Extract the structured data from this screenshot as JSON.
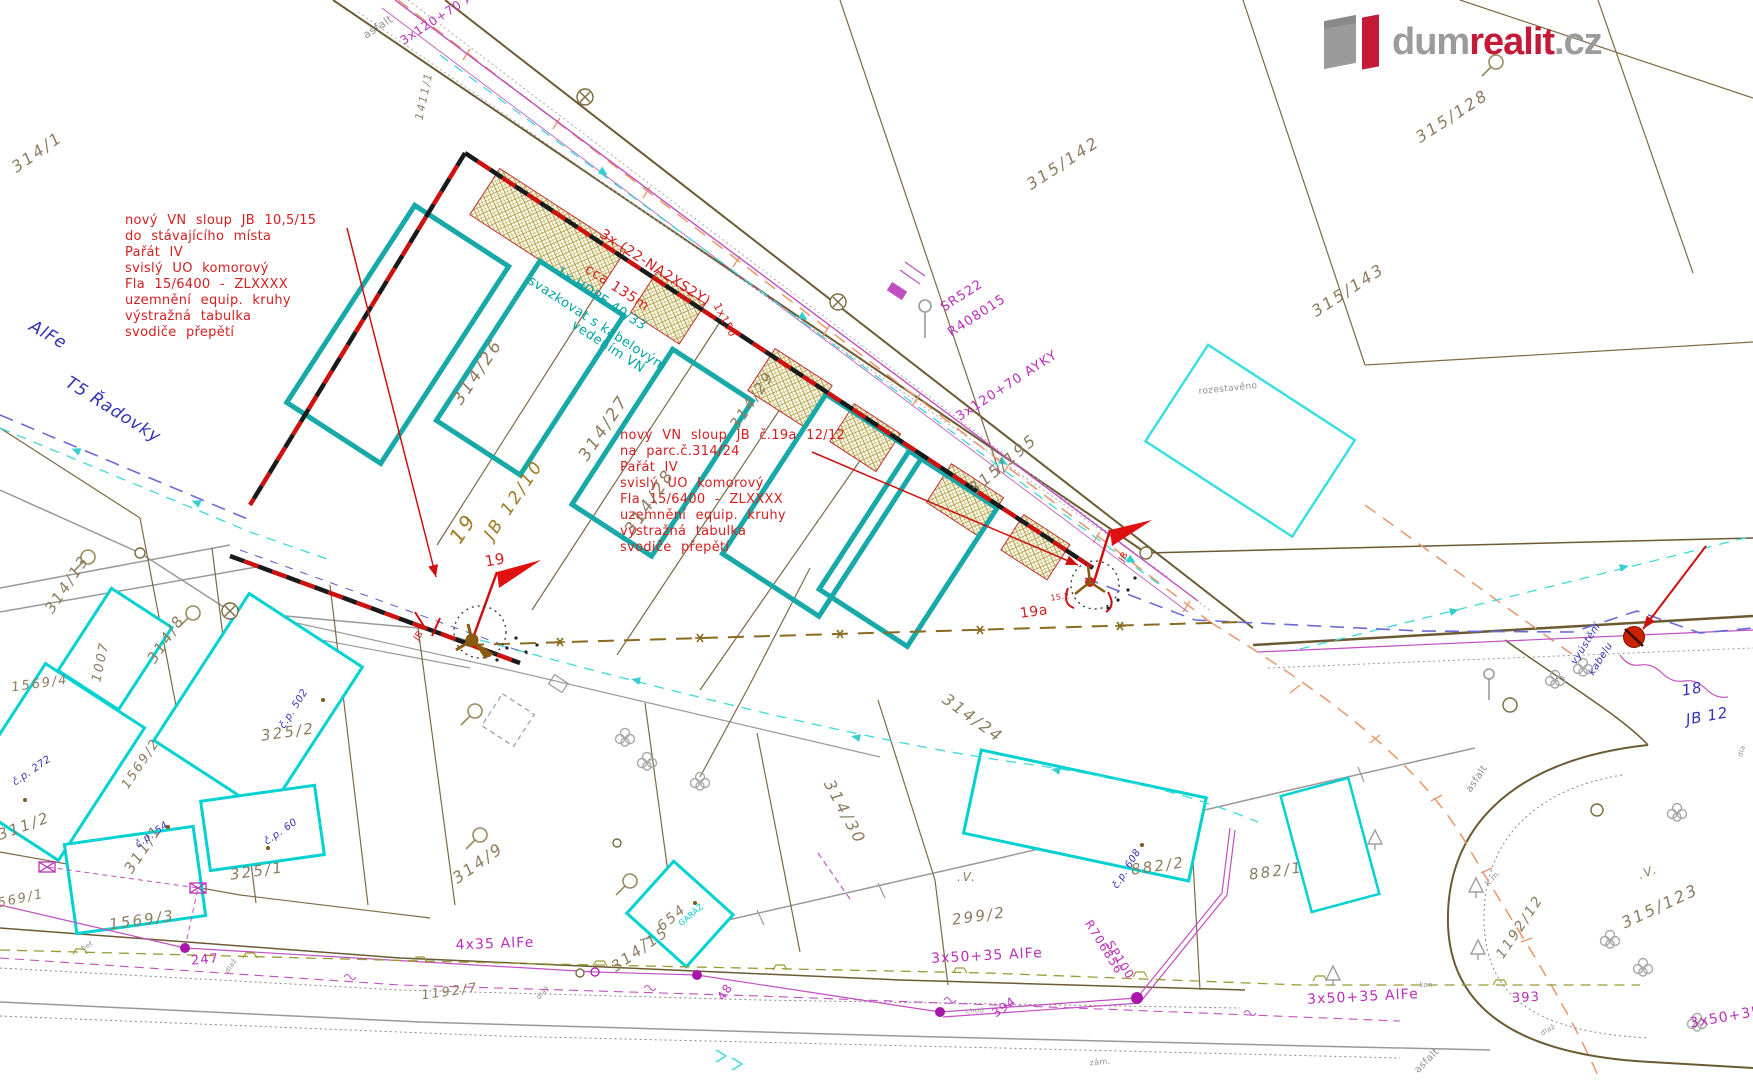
{
  "colors": {
    "brand_red": "#c41937",
    "logo_gray": "#9b9b9b",
    "note_red": "#d21f1f",
    "parcel_brown": "#8d7b5e",
    "utility_magenta": "#bb2fbb",
    "cable_teal": "#00a3a3",
    "house_blue": "#3232b8",
    "map_gray": "#909090",
    "pole_brown": "#a07820"
  },
  "logo": {
    "dum": "dum",
    "realit": "realit",
    "tld": ".cz"
  },
  "blocks": {
    "left": {
      "x": 125,
      "y": 213,
      "lines": [
        "nový VN sloup JB 10,5/15",
        "do stávajícího místa",
        "Pařát IV",
        "svislý UO komorový",
        "Fla 15/6400 - ZLXXXX",
        "uzemnění equip. kruhy",
        "výstražná tabulka",
        "svodiče přepětí"
      ]
    },
    "center": {
      "x": 620,
      "y": 428,
      "lines": [
        "nový VN sloup JB č.19a 12/12",
        "na parc.č.314/24",
        "Pařát IV",
        "svislý UO komorový",
        "Fla 15/6400 - ZLXXXX",
        "uzemnění equip. kruhy",
        "výstražná tabulka",
        "svodiče přepětí"
      ]
    }
  },
  "labels": [
    {
      "t": "314/1",
      "x": 37,
      "y": 152,
      "r": -35,
      "c": "#8d7b5e",
      "s": 16,
      "cls": "parcel"
    },
    {
      "t": "1411/1",
      "x": 424,
      "y": 96,
      "r": -78,
      "c": "#8d7b5e",
      "s": 11,
      "cls": "parcel"
    },
    {
      "t": "asfalt",
      "x": 378,
      "y": 27,
      "r": -33,
      "c": "#909090",
      "s": 11,
      "cls": "note"
    },
    {
      "t": "3x120+70 AYKY",
      "x": 447,
      "y": 12,
      "r": -33,
      "c": "#bb2fbb",
      "s": 12,
      "cls": "util"
    },
    {
      "t": "SR522",
      "x": 962,
      "y": 296,
      "r": -33,
      "c": "#bb2fbb",
      "s": 13,
      "cls": "util"
    },
    {
      "t": "R408015",
      "x": 977,
      "y": 316,
      "r": -33,
      "c": "#bb2fbb",
      "s": 13,
      "cls": "util"
    },
    {
      "t": "3x120+70 AYKY",
      "x": 1007,
      "y": 386,
      "r": -33,
      "c": "#bb2fbb",
      "s": 13,
      "cls": "util"
    },
    {
      "t": "315/128",
      "x": 1452,
      "y": 116,
      "r": -33,
      "c": "#8d7b5e",
      "s": 16,
      "cls": "parcel"
    },
    {
      "t": "315/142",
      "x": 1063,
      "y": 163,
      "r": -33,
      "c": "#8d7b5e",
      "s": 16,
      "cls": "parcel"
    },
    {
      "t": "315/143",
      "x": 1348,
      "y": 290,
      "r": -33,
      "c": "#8d7b5e",
      "s": 16,
      "cls": "parcel"
    },
    {
      "t": "315/195",
      "x": 1003,
      "y": 464,
      "r": -40,
      "c": "#8d7b5e",
      "s": 16,
      "cls": "parcel"
    },
    {
      "t": "rozestavěno",
      "x": 1228,
      "y": 389,
      "r": -6,
      "c": "#909090",
      "s": 9,
      "cls": "note"
    },
    {
      "t": "314/26",
      "x": 478,
      "y": 372,
      "r": -56,
      "c": "#8d7b5e",
      "s": 17,
      "cls": "parcel"
    },
    {
      "t": "314/27",
      "x": 604,
      "y": 428,
      "r": -56,
      "c": "#8d7b5e",
      "s": 17,
      "cls": "parcel"
    },
    {
      "t": "314/28",
      "x": 650,
      "y": 502,
      "r": -56,
      "c": "#8d7b5e",
      "s": 17,
      "cls": "parcel"
    },
    {
      "t": "314/29",
      "x": 752,
      "y": 400,
      "r": -56,
      "c": "#8d7b5e",
      "s": 15,
      "cls": "parcel"
    },
    {
      "t": "19",
      "x": 463,
      "y": 528,
      "r": -56,
      "c": "#a07820",
      "s": 20,
      "cls": "parcel"
    },
    {
      "t": "JB 12/10",
      "x": 514,
      "y": 500,
      "r": -56,
      "c": "#a07820",
      "s": 17,
      "cls": "parcel"
    },
    {
      "t": "3x (22-NA2XS2Y)",
      "x": 655,
      "y": 268,
      "r": 33,
      "c": "#d21f1f",
      "s": 14,
      "cls": "note"
    },
    {
      "t": "cca 135m",
      "x": 617,
      "y": 288,
      "r": 33,
      "c": "#d21f1f",
      "s": 14,
      "cls": "note"
    },
    {
      "t": "1x150",
      "x": 725,
      "y": 320,
      "r": 62,
      "c": "#d21f1f",
      "s": 11,
      "cls": "note"
    },
    {
      "t": "1x HDPE 40/33",
      "x": 601,
      "y": 299,
      "r": 33,
      "c": "#00a3a3",
      "s": 13,
      "cls": "note"
    },
    {
      "t": "svazkovat s kabelovým",
      "x": 597,
      "y": 324,
      "r": 33,
      "c": "#00a3a3",
      "s": 13,
      "cls": "note"
    },
    {
      "t": "vedením VN",
      "x": 608,
      "y": 347,
      "r": 33,
      "c": "#00a3a3",
      "s": 13,
      "cls": "note"
    },
    {
      "t": "AlFe",
      "x": 48,
      "y": 335,
      "r": 30,
      "c": "#3232b8",
      "s": 17,
      "cls": "house"
    },
    {
      "t": "T5 Řadovky",
      "x": 113,
      "y": 410,
      "r": 32,
      "c": "#3232b8",
      "s": 17,
      "cls": "house"
    },
    {
      "t": "19",
      "x": 495,
      "y": 560,
      "r": -10,
      "c": "#d21f1f",
      "s": 15,
      "cls": "note"
    },
    {
      "t": "JB",
      "x": 419,
      "y": 636,
      "r": -56,
      "c": "#d21f1f",
      "s": 9,
      "cls": "note"
    },
    {
      "t": "19a",
      "x": 1034,
      "y": 612,
      "r": -8,
      "c": "#d21f1f",
      "s": 14,
      "cls": "note"
    },
    {
      "t": "15.2",
      "x": 1060,
      "y": 597,
      "r": -8,
      "c": "#d21f1f",
      "s": 8,
      "cls": "note"
    },
    {
      "t": "JB",
      "x": 1124,
      "y": 557,
      "r": -56,
      "c": "#d21f1f",
      "s": 9,
      "cls": "note"
    },
    {
      "t": "314/24",
      "x": 973,
      "y": 718,
      "r": 36,
      "c": "#8d7b5e",
      "s": 16,
      "cls": "parcel"
    },
    {
      "t": "314/30",
      "x": 845,
      "y": 812,
      "r": 62,
      "c": "#8d7b5e",
      "s": 16,
      "cls": "parcel"
    },
    {
      "t": "314/13",
      "x": 67,
      "y": 584,
      "r": -56,
      "c": "#8d7b5e",
      "s": 15,
      "cls": "parcel"
    },
    {
      "t": "314/8",
      "x": 166,
      "y": 639,
      "r": -56,
      "c": "#8d7b5e",
      "s": 15,
      "cls": "parcel"
    },
    {
      "t": "1007",
      "x": 101,
      "y": 662,
      "r": -78,
      "c": "#8d7b5e",
      "s": 13,
      "cls": "parcel"
    },
    {
      "t": "1569/4",
      "x": 40,
      "y": 684,
      "r": -8,
      "c": "#8d7b5e",
      "s": 13,
      "cls": "parcel"
    },
    {
      "t": "1569/2",
      "x": 141,
      "y": 764,
      "r": -56,
      "c": "#8d7b5e",
      "s": 13,
      "cls": "parcel"
    },
    {
      "t": "1569/1",
      "x": 16,
      "y": 900,
      "r": -12,
      "c": "#8d7b5e",
      "s": 13,
      "cls": "parcel"
    },
    {
      "t": "1569/3",
      "x": 142,
      "y": 920,
      "r": -8,
      "c": "#8d7b5e",
      "s": 15,
      "cls": "parcel"
    },
    {
      "t": "311/2",
      "x": 24,
      "y": 826,
      "r": -20,
      "c": "#8d7b5e",
      "s": 15,
      "cls": "parcel"
    },
    {
      "t": "311/1",
      "x": 143,
      "y": 849,
      "r": -56,
      "c": "#8d7b5e",
      "s": 15,
      "cls": "parcel"
    },
    {
      "t": "325/2",
      "x": 288,
      "y": 732,
      "r": -8,
      "c": "#8d7b5e",
      "s": 15,
      "cls": "parcel"
    },
    {
      "t": "325/1",
      "x": 257,
      "y": 871,
      "r": -8,
      "c": "#8d7b5e",
      "s": 15,
      "cls": "parcel"
    },
    {
      "t": "č.p. 502",
      "x": 294,
      "y": 709,
      "r": -58,
      "c": "#3232b8",
      "s": 10,
      "cls": "house"
    },
    {
      "t": "č.p. 272",
      "x": 32,
      "y": 771,
      "r": -35,
      "c": "#3232b8",
      "s": 10,
      "cls": "house"
    },
    {
      "t": "č.p. 54",
      "x": 152,
      "y": 835,
      "r": -35,
      "c": "#3232b8",
      "s": 10,
      "cls": "house"
    },
    {
      "t": "č.p. 60",
      "x": 281,
      "y": 832,
      "r": -35,
      "c": "#3232b8",
      "s": 10,
      "cls": "house"
    },
    {
      "t": "314/9",
      "x": 478,
      "y": 863,
      "r": -35,
      "c": "#8d7b5e",
      "s": 16,
      "cls": "parcel"
    },
    {
      "t": "654",
      "x": 672,
      "y": 918,
      "r": -40,
      "c": "#8d7b5e",
      "s": 14,
      "cls": "parcel"
    },
    {
      "t": "GARÁŽ",
      "x": 691,
      "y": 915,
      "r": -40,
      "c": "#00cccc",
      "s": 8,
      "cls": "note"
    },
    {
      "t": "314/15",
      "x": 640,
      "y": 949,
      "r": -35,
      "c": "#8d7b5e",
      "s": 15,
      "cls": "parcel"
    },
    {
      "t": "4x35 AlFe",
      "x": 495,
      "y": 944,
      "r": -2,
      "c": "#bb2fbb",
      "s": 14,
      "cls": "util"
    },
    {
      "t": "1192/7",
      "x": 450,
      "y": 992,
      "r": -8,
      "c": "#8d7b5e",
      "s": 13,
      "cls": "parcel"
    },
    {
      "t": "48",
      "x": 725,
      "y": 992,
      "r": -56,
      "c": "#bb2fbb",
      "s": 12,
      "cls": "util"
    },
    {
      "t": "247",
      "x": 205,
      "y": 960,
      "r": -5,
      "c": "#bb2fbb",
      "s": 13,
      "cls": "util"
    },
    {
      "t": "bet",
      "x": 87,
      "y": 946,
      "r": -30,
      "c": "#909090",
      "s": 7,
      "cls": "note"
    },
    {
      "t": "dlaž",
      "x": 231,
      "y": 966,
      "r": -56,
      "c": "#909090",
      "s": 7,
      "cls": "note"
    },
    {
      "t": "dlaž",
      "x": 543,
      "y": 993,
      "r": -45,
      "c": "#909090",
      "s": 7,
      "cls": "note"
    },
    {
      "t": "chod",
      "x": 975,
      "y": 1011,
      "r": -4,
      "c": "#909090",
      "s": 7,
      "cls": "note"
    },
    {
      "t": "zám.",
      "x": 1100,
      "y": 1062,
      "r": -5,
      "c": "#909090",
      "s": 8,
      "cls": "note"
    },
    {
      "t": "299/2",
      "x": 979,
      "y": 916,
      "r": -8,
      "c": "#8d7b5e",
      "s": 15,
      "cls": "parcel"
    },
    {
      "t": ".V.",
      "x": 967,
      "y": 877,
      "r": 0,
      "c": "#8d7b5e",
      "s": 12,
      "cls": "parcel"
    },
    {
      "t": "3x50+35 AlFe",
      "x": 987,
      "y": 956,
      "r": -3,
      "c": "#bb2fbb",
      "s": 14,
      "cls": "util"
    },
    {
      "t": "394",
      "x": 1004,
      "y": 1007,
      "r": -35,
      "c": "#bb2fbb",
      "s": 12,
      "cls": "util"
    },
    {
      "t": "R706856",
      "x": 1104,
      "y": 947,
      "r": 58,
      "c": "#bb2fbb",
      "s": 12,
      "cls": "util"
    },
    {
      "t": "SP100",
      "x": 1120,
      "y": 960,
      "r": 58,
      "c": "#bb2fbb",
      "s": 12,
      "cls": "util"
    },
    {
      "t": "882/2",
      "x": 1158,
      "y": 866,
      "r": -8,
      "c": "#8d7b5e",
      "s": 15,
      "cls": "parcel"
    },
    {
      "t": "č.p. 608",
      "x": 1127,
      "y": 869,
      "r": -58,
      "c": "#3232b8",
      "s": 10,
      "cls": "house"
    },
    {
      "t": "882/1",
      "x": 1276,
      "y": 871,
      "r": -8,
      "c": "#8d7b5e",
      "s": 15,
      "cls": "parcel"
    },
    {
      "t": "18",
      "x": 1692,
      "y": 689,
      "r": -10,
      "c": "#3232b8",
      "s": 15,
      "cls": "house"
    },
    {
      "t": "JB 12",
      "x": 1707,
      "y": 716,
      "r": -10,
      "c": "#3232b8",
      "s": 15,
      "cls": "house"
    },
    {
      "t": "vyústění",
      "x": 1586,
      "y": 644,
      "r": -58,
      "c": "#3232b8",
      "s": 10,
      "cls": "house"
    },
    {
      "t": "kabelu",
      "x": 1601,
      "y": 659,
      "r": -58,
      "c": "#3232b8",
      "s": 10,
      "cls": "house"
    },
    {
      "t": "asfalt",
      "x": 1477,
      "y": 779,
      "r": -56,
      "c": "#909090",
      "s": 10,
      "cls": "note"
    },
    {
      "t": "1192/12",
      "x": 1520,
      "y": 927,
      "r": -56,
      "c": "#8d7b5e",
      "s": 14,
      "cls": "parcel"
    },
    {
      "t": "315/123",
      "x": 1660,
      "y": 906,
      "r": -25,
      "c": "#8d7b5e",
      "s": 16,
      "cls": "parcel"
    },
    {
      "t": ".V.",
      "x": 1648,
      "y": 872,
      "r": -20,
      "c": "#8d7b5e",
      "s": 12,
      "cls": "parcel"
    },
    {
      "t": "393",
      "x": 1526,
      "y": 998,
      "r": -3,
      "c": "#bb2fbb",
      "s": 13,
      "cls": "util"
    },
    {
      "t": "k.m.",
      "x": 1493,
      "y": 878,
      "r": -45,
      "c": "#909090",
      "s": 8,
      "cls": "note"
    },
    {
      "t": "kon",
      "x": 1426,
      "y": 985,
      "r": 0,
      "c": "#909090",
      "s": 7,
      "cls": "note"
    },
    {
      "t": "3x50+35 AlFe",
      "x": 1363,
      "y": 997,
      "r": -3,
      "c": "#bb2fbb",
      "s": 14,
      "cls": "util"
    },
    {
      "t": "3x50+35 AlFe",
      "x": 1745,
      "y": 1014,
      "r": -10,
      "c": "#bb2fbb",
      "s": 14,
      "cls": "util"
    },
    {
      "t": "asfalt",
      "x": 1427,
      "y": 1061,
      "r": -45,
      "c": "#909090",
      "s": 10,
      "cls": "note"
    },
    {
      "t": "dla.",
      "x": 1742,
      "y": 750,
      "r": -75,
      "c": "#909090",
      "s": 7,
      "cls": "note"
    },
    {
      "t": "dlaž",
      "x": 1548,
      "y": 1030,
      "r": -30,
      "c": "#909090",
      "s": 7,
      "cls": "note"
    }
  ]
}
